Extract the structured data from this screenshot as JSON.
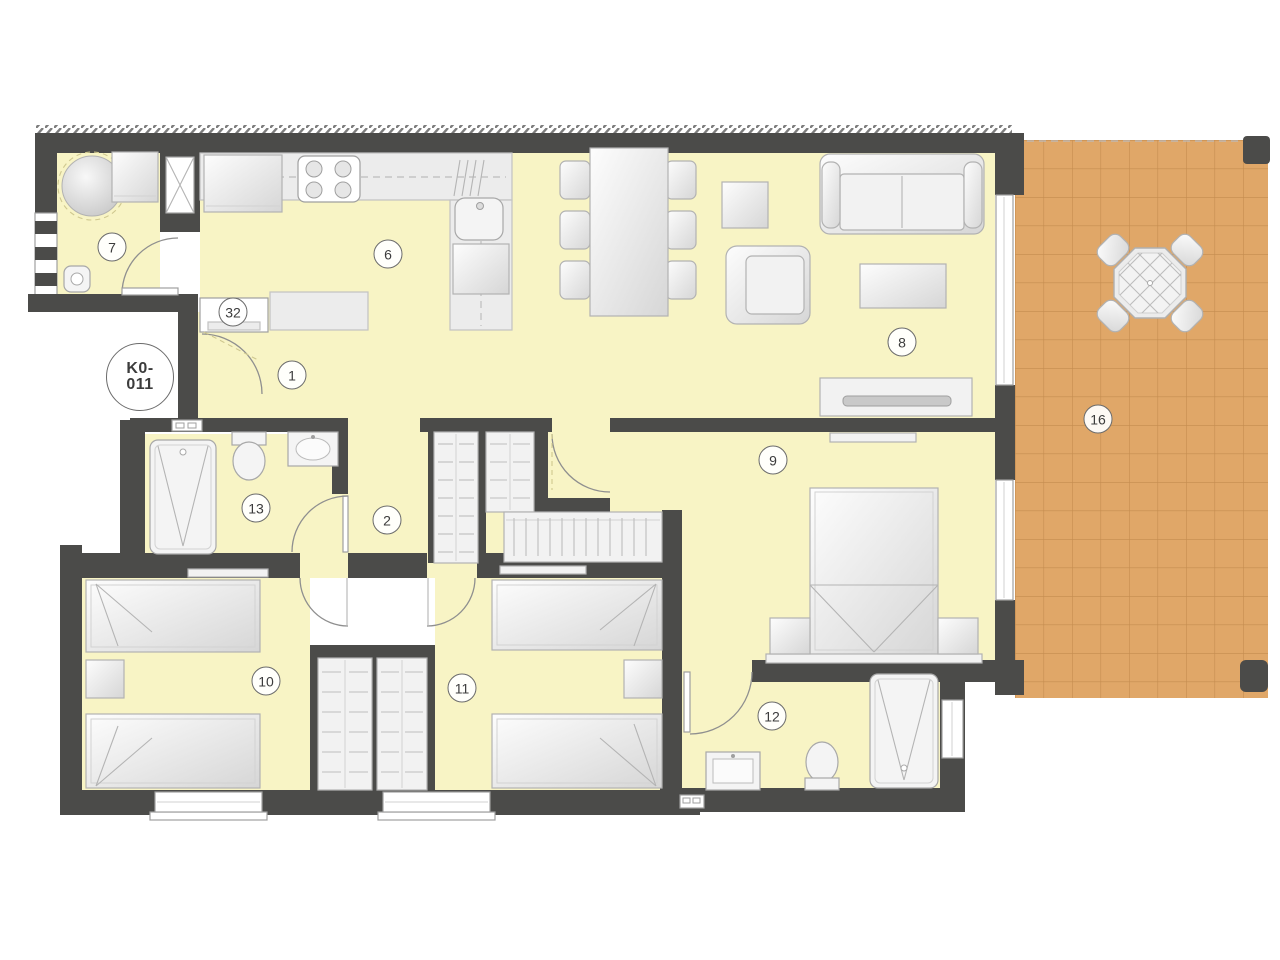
{
  "plan": {
    "unit_id": "K0-011",
    "unit_id_line1": "K0-",
    "unit_id_line2": "011",
    "labels": {
      "entrance_hall": "1",
      "hallway": "2",
      "kitchen": "6",
      "utility_room": "7",
      "living_dining_room": "8",
      "bedroom_main": "9",
      "bedroom_2": "10",
      "bedroom_3": "11",
      "bathroom_2": "12",
      "bathroom_main": "13",
      "terrace": "16",
      "entrance": "32"
    },
    "colors": {
      "wall": "#4b4b49",
      "floor": "#f8f4c5",
      "terrace": "#e0a768",
      "terrace-grid": "#c18a4d",
      "counter": "#ececec",
      "furniture-stroke": "#b2b2b2",
      "label-ink": "#3c3c3c",
      "outside": "#ffffff"
    },
    "furniture_icons": [
      "boiler",
      "washing-machine",
      "floor-drain",
      "fridge",
      "cooktop",
      "kitchen-sink",
      "dishwasher",
      "kitchen-counter",
      "dining-table",
      "dining-chair",
      "side-table",
      "armchair",
      "sofa",
      "coffee-table",
      "tv-sideboard",
      "double-bed",
      "single-bed",
      "nightstand",
      "wardrobe",
      "walk-in-closet",
      "shower",
      "toilet",
      "washbasin",
      "terrace-table",
      "terrace-chair",
      "window",
      "door-swing"
    ]
  }
}
